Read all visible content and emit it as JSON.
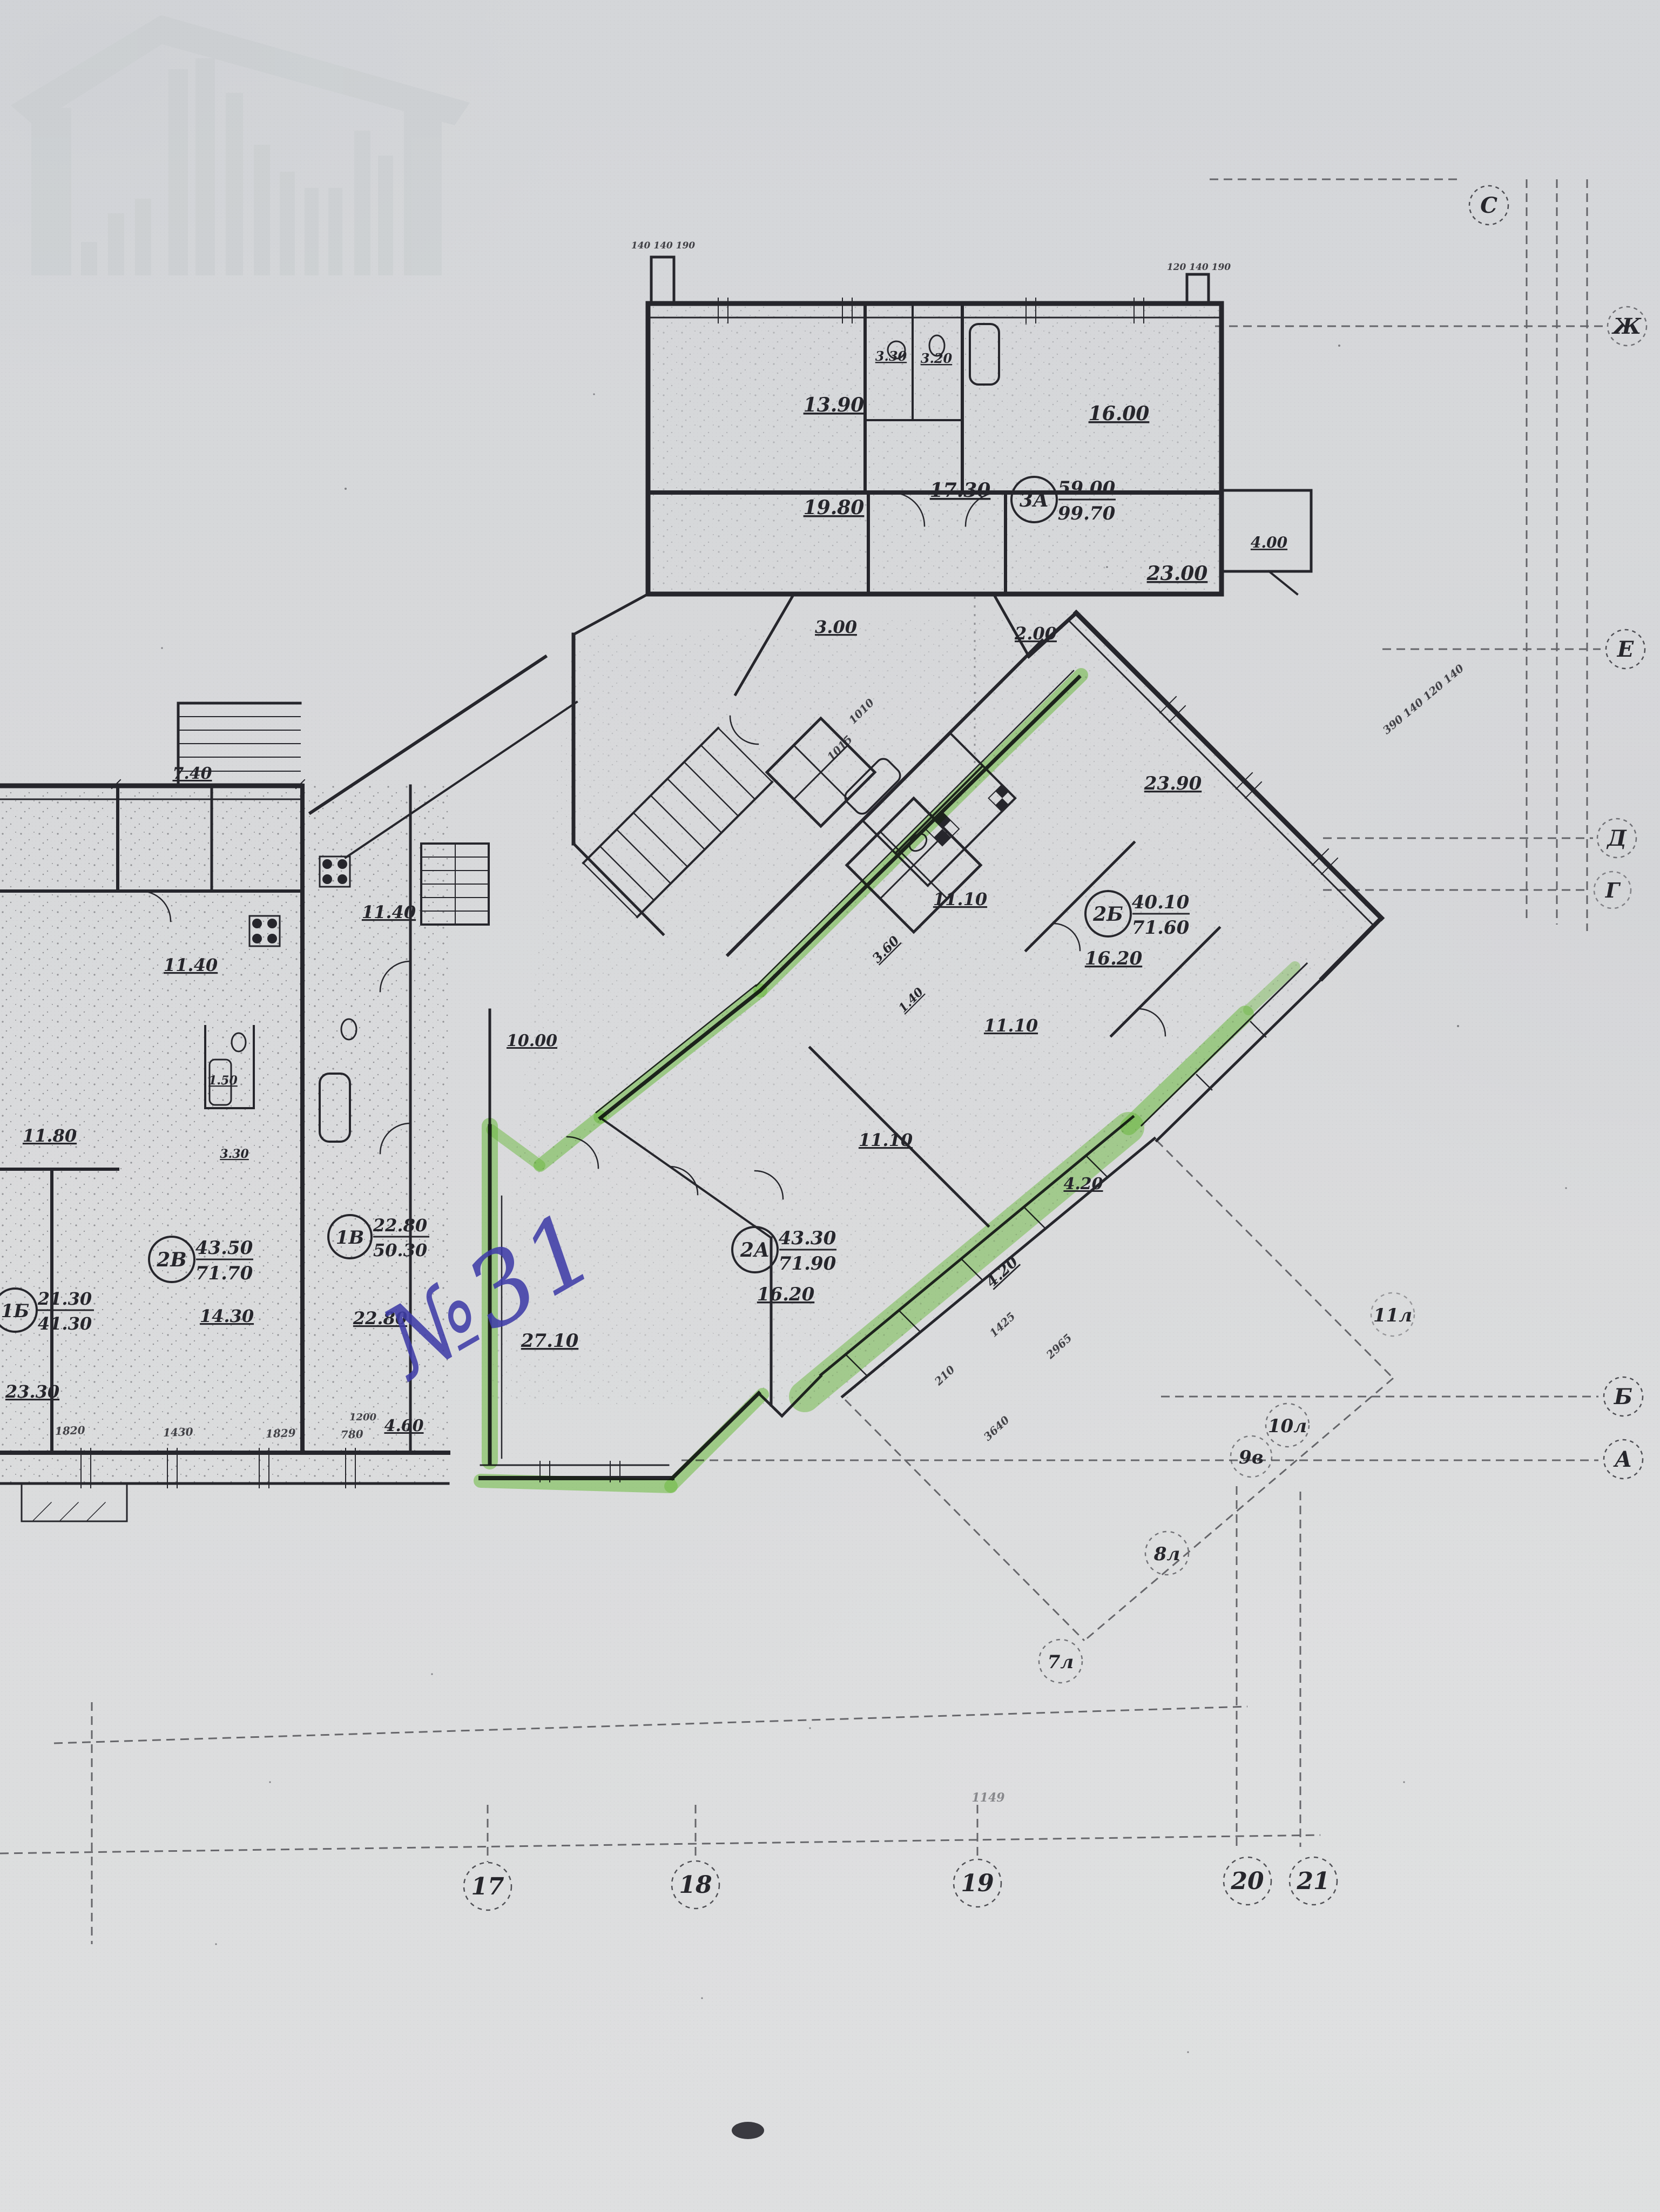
{
  "photo": {
    "kind": "scanned floor plan with highlighter markup",
    "paper_color": "#d8d9db",
    "ink_color": "#26262c",
    "highlight_color": "#7ed848",
    "pen_color": "#3f3da8"
  },
  "handwritten_note": {
    "text": "№31"
  },
  "apartments": [
    {
      "code": "3А",
      "area_top": "59.00",
      "area_bottom": "99.70"
    },
    {
      "code": "2Б",
      "area_top": "40.10",
      "area_bottom": "71.60"
    },
    {
      "code": "2А",
      "area_top": "43.30",
      "area_bottom": "71.90"
    },
    {
      "code": "2В",
      "area_top": "43.50",
      "area_bottom": "71.70"
    },
    {
      "code": "1В",
      "area_top": "22.80",
      "area_bottom": "50.30"
    },
    {
      "code": "1Б",
      "area_top": "21.30",
      "area_bottom": "41.30"
    }
  ],
  "rooms": [
    {
      "t": "13.90"
    },
    {
      "t": "16.00"
    },
    {
      "t": "19.80"
    },
    {
      "t": "17.30"
    },
    {
      "t": "23.00"
    },
    {
      "t": "3.30"
    },
    {
      "t": "3.20"
    },
    {
      "t": "4.00"
    },
    {
      "t": "3.00"
    },
    {
      "t": "2.00"
    },
    {
      "t": "23.90"
    },
    {
      "t": "11.10"
    },
    {
      "t": "16.20"
    },
    {
      "t": "11.10"
    },
    {
      "t": "11.10"
    },
    {
      "t": "16.20"
    },
    {
      "t": "27.10"
    },
    {
      "t": "10.00"
    },
    {
      "t": "4.20"
    },
    {
      "t": "4.20"
    },
    {
      "t": "3.60"
    },
    {
      "t": "1.40"
    },
    {
      "t": "7.40"
    },
    {
      "t": "11.40"
    },
    {
      "t": "11.40"
    },
    {
      "t": "11.80"
    },
    {
      "t": "1.50"
    },
    {
      "t": "3.30"
    },
    {
      "t": "14.30"
    },
    {
      "t": "22.80"
    },
    {
      "t": "23.30"
    },
    {
      "t": "4.60"
    }
  ],
  "dims": [
    {
      "t": "1820"
    },
    {
      "t": "1430"
    },
    {
      "t": "1829"
    },
    {
      "t": "780"
    },
    {
      "t": "1200"
    },
    {
      "t": "1010"
    },
    {
      "t": "1015"
    },
    {
      "t": "1425"
    },
    {
      "t": "210"
    },
    {
      "t": "2965"
    },
    {
      "t": "3640"
    },
    {
      "t": "390 140 120 140"
    },
    {
      "t": "140 140 190"
    },
    {
      "t": "120 140 190"
    },
    {
      "t": "1149"
    }
  ],
  "axes": {
    "letters": [
      {
        "t": "С"
      },
      {
        "t": "Ж"
      },
      {
        "t": "Е"
      },
      {
        "t": "Д"
      },
      {
        "t": "Г"
      },
      {
        "t": "Б"
      },
      {
        "t": "А"
      }
    ],
    "numbers": [
      {
        "t": "17"
      },
      {
        "t": "18"
      },
      {
        "t": "19"
      },
      {
        "t": "20"
      },
      {
        "t": "21"
      }
    ],
    "intermediate": [
      {
        "t": "11л"
      },
      {
        "t": "10л"
      },
      {
        "t": "9в"
      },
      {
        "t": "8л"
      },
      {
        "t": "7л"
      }
    ]
  }
}
